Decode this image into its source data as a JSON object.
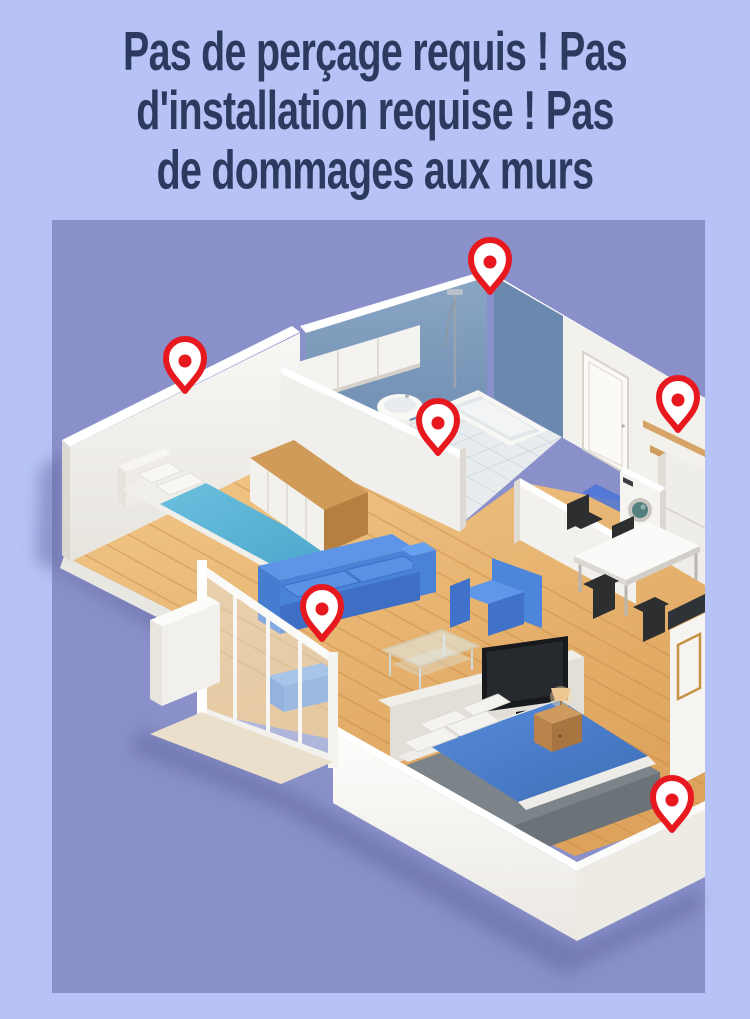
{
  "theme": {
    "page-bg": "#b7c3f6",
    "headline-color": "#2b3a5e",
    "panel-bg": "#8a90c9",
    "pin-red": "#e8181f"
  },
  "headline": {
    "lines": [
      "Pas de perçage requis ! Pas",
      "d'installation requise ! Pas",
      "de dommages aux murs"
    ]
  },
  "floorplan": {
    "panel": {
      "x": 52,
      "y": 220,
      "width": 653,
      "height": 773,
      "background_color": "#8a90c9"
    },
    "pin": {
      "outline_color": "#e8181f",
      "fill_color": "#ffffff",
      "dot_color": "#e8181f"
    },
    "pins": [
      {
        "id": "pin-bedroom-wall",
        "x": 185,
        "y": 361
      },
      {
        "id": "pin-bathroom-shower-wall",
        "x": 490,
        "y": 262
      },
      {
        "id": "pin-bathroom-partition-wall",
        "x": 438,
        "y": 423
      },
      {
        "id": "pin-kitchen-shelf-wall",
        "x": 678,
        "y": 400
      },
      {
        "id": "pin-living-room-glass-wall",
        "x": 322,
        "y": 609
      },
      {
        "id": "pin-bedroom2-floor",
        "x": 672,
        "y": 800
      }
    ]
  }
}
